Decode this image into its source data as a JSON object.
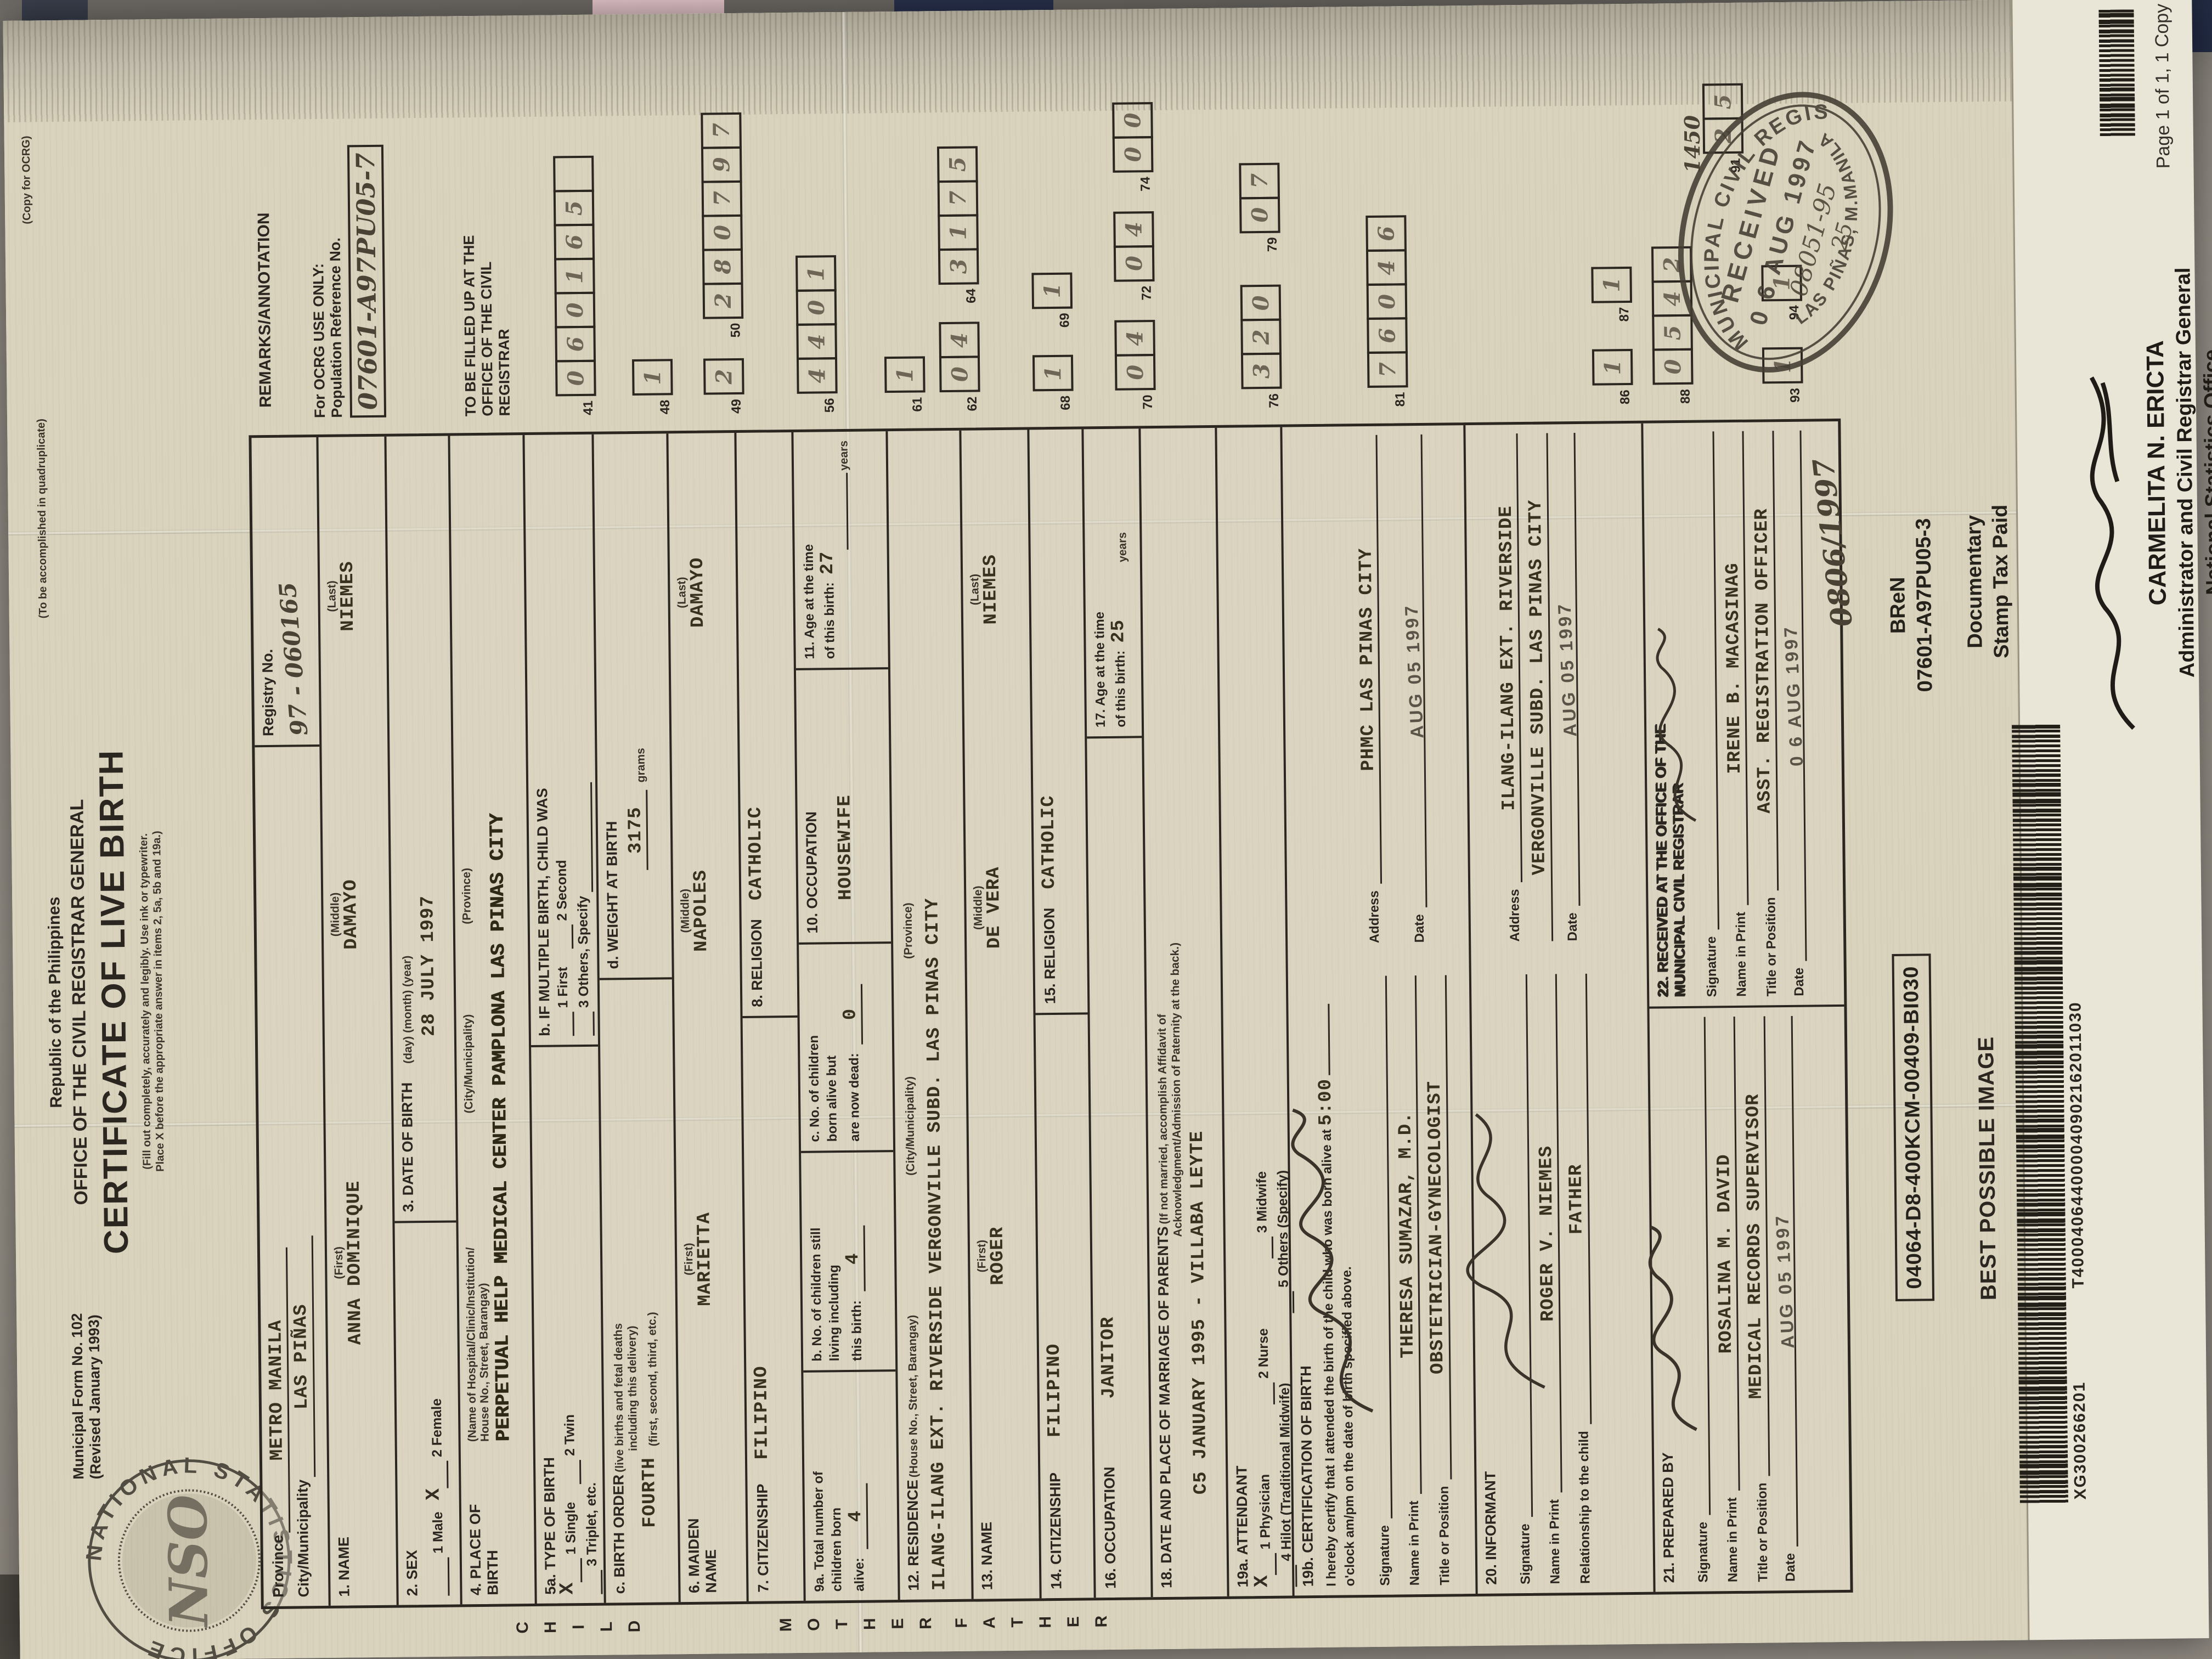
{
  "colors": {
    "paper": "#d9d3bd",
    "secpa": "#eae6d7",
    "ink": "#2b2620"
  },
  "page": {
    "copy_label": "Page 1 of 1, 1 Copy",
    "copy_for": "(Copy for OCRG)",
    "quadruplicate": "(To be accomplished in quadruplicate)"
  },
  "header": {
    "form_no": "Municipal Form No. 102",
    "revised": "(Revised January 1993)",
    "republic": "Republic of the Philippines",
    "office": "OFFICE OF THE CIVIL REGISTRAR GENERAL",
    "title": "CERTIFICATE OF LIVE BIRTH",
    "instr1": "(Fill out completely, accurately and legibly. Use ink or typewriter.",
    "instr2": "Place X before the appropriate answer in items 2, 5a, 5b and 19a.)"
  },
  "seal": {
    "ring_text": "NATIONAL STATISTICS OFFICE",
    "center": "NSO"
  },
  "registry": {
    "province_label": "Province",
    "province": "METRO MANILA",
    "city_label": "City/Municipality",
    "city": "LAS PIÑAS",
    "registry_label": "Registry No.",
    "registry_value": "97 - 060165"
  },
  "child": {
    "side": "CHILD",
    "name_label": "1. NAME",
    "first_label": "(First)",
    "middle_label": "(Middle)",
    "last_label": "(Last)",
    "first": "ANNA DOMINIQUE",
    "middle": "DAMAYO",
    "last": "NIEMES",
    "sex_label": "2. SEX",
    "male": "1 Male",
    "female": "2 Female",
    "sex_mark": "X",
    "dob_label": "3. DATE OF BIRTH",
    "dob_sub": "(day)   (month)   (year)",
    "dob": "28 JULY 1997",
    "pob_label": "4. PLACE OF",
    "pob_label2": "BIRTH",
    "pob_sub1": "(Name of Hospital/Clinic/Institution/",
    "pob_sub2": "House No., Street, Barangay)",
    "pob_sub3": "(City/Municipality)",
    "pob_sub4": "(Province)",
    "pob": "PERPETUAL HELP MEDICAL CENTER PAMPLONA LAS PINAS CITY",
    "tob_label": "5a. TYPE OF BIRTH",
    "tob_mark": "X",
    "tob1": "1 Single",
    "tob2": "2 Twin",
    "tob3": "3 Triplet, etc.",
    "mult_label": "b. IF MULTIPLE BIRTH, CHILD WAS",
    "mult1": "1 First",
    "mult2": "2 Second",
    "mult3": "3 Others, Specify",
    "order_label": "c. BIRTH ORDER",
    "order_sub1": "(live births and fetal deaths",
    "order_sub2": "including this delivery)",
    "order_sub3": "(first, second, third, etc.)",
    "order": "FOURTH",
    "weight_label": "d. WEIGHT AT BIRTH",
    "weight": "3175",
    "grams": "grams"
  },
  "mother": {
    "side": "MOTHER",
    "name_label": "6. MAIDEN",
    "name_label2": "NAME",
    "first": "MARIETTA",
    "middle": "NAPOLES",
    "last": "DAMAYO",
    "cit_label": "7. CITIZENSHIP",
    "cit": "FILIPINO",
    "rel_label": "8. RELIGION",
    "rel": "CATHOLIC",
    "a1": "9a. Total number of",
    "a2": "children born",
    "a3": "alive:",
    "a": "4",
    "b1": "b. No. of children still",
    "b2": "living including",
    "b3": "this birth:",
    "b": "4",
    "c1": "c. No. of children",
    "c2": "born alive but",
    "c3": "are now dead:",
    "c": "0",
    "occ_label": "10. OCCUPATION",
    "occ": "HOUSEWIFE",
    "age1": "11. Age at the time",
    "age2": "of this birth:",
    "age": "27",
    "years": "years",
    "res_label": "12. RESIDENCE",
    "res_sub1": "(House No., Street, Barangay)",
    "res_sub2": "(City/Municipality)",
    "res_sub3": "(Province)",
    "res": "ILANG-ILANG EXT. RIVERSIDE VERGONVILLE SUBD. LAS PINAS CITY"
  },
  "father": {
    "side": "FATHER",
    "name_label": "13. NAME",
    "first": "ROGER",
    "middle": "DE VERA",
    "last": "NIEMES",
    "cit_label": "14. CITIZENSHIP",
    "cit": "FILIPINO",
    "rel_label": "15. RELIGION",
    "rel": "CATHOLIC",
    "occ_label": "16. OCCUPATION",
    "occ": "JANITOR",
    "age1": "17. Age at the time",
    "age2": "of this birth:",
    "age": "25",
    "years": "years"
  },
  "marriage": {
    "label": "18. DATE AND PLACE OF MARRIAGE OF PARENTS",
    "note1": "(If not married, accomplish Affidavit of",
    "note2": "Acknowledgment/Admission of Paternity at the back.)",
    "value": "C5 JANUARY 1995 - VILLABA LEYTE"
  },
  "attendant": {
    "label": "19a. ATTENDANT",
    "mark": "X",
    "o1": "1 Physician",
    "o2": "2 Nurse",
    "o3": "3 Midwife",
    "o4": "4 Hilot (Traditional Midwife)",
    "o5": "5 Others (Specify)"
  },
  "certification": {
    "label": "19b. CERTIFICATION OF BIRTH",
    "text1": "I hereby certify that I attended the birth of the child who was born alive at",
    "time": "5:00",
    "text2": "o'clock",
    "text3": "am/pm on the date of birth specified above.",
    "sig_label": "Signature",
    "name_label": "Name in Print",
    "name": "THERESA SUMAZAR, M.D.",
    "title_label": "Title or Position",
    "title": "OBSTETRICIAN-GYNECOLOGIST",
    "addr_label": "Address",
    "addr": "PHMC LAS PINAS CITY",
    "date_label": "Date",
    "date": "AUG 05 1997"
  },
  "informant": {
    "label": "20. INFORMANT",
    "sig_label": "Signature",
    "name_label": "Name in Print",
    "name": "ROGER V. NIEMES",
    "rel_label": "Relationship to the child",
    "rel": "FATHER",
    "addr_label": "Address",
    "addr1": "ILANG-ILANG EXT. RIVERSIDE",
    "addr2": "VERGONVILLE SUBD. LAS PINAS CITY",
    "date_label": "Date",
    "date": "AUG 05 1997"
  },
  "prepared": {
    "label": "21. PREPARED BY",
    "sig_label": "Signature",
    "name_label": "Name in Print",
    "name": "ROSALINA M. DAVID",
    "title_label": "Title or Position",
    "title": "MEDICAL RECORDS SUPERVISOR",
    "date_label": "Date",
    "date": "AUG 05 1997"
  },
  "received": {
    "label": "22. RECEIVED AT THE OFFICE OF THE",
    "label2": "MUNICIPAL CIVIL REGISTRAR",
    "sig_label": "Signature",
    "name_label": "Name in Print",
    "name": "IRENE B. MACASINAG",
    "title_label": "Title or Position",
    "title": "ASST. REGISTRATION OFFICER",
    "date_label": "Date",
    "date": "0 6 AUG 1997"
  },
  "ocrg": {
    "remarks_title": "REMARKS/ANNOTATION",
    "ocrg_only": "For OCRG USE ONLY:",
    "pop_ref": "Population Reference No.",
    "pop_ref_value": "07601-A97PU05-7",
    "fill_up1": "TO BE FILLED UP AT THE",
    "fill_up2": "OFFICE OF THE CIVIL",
    "fill_up3": "REGISTRAR",
    "g41": {
      "label": "41",
      "digits": "060165_"
    },
    "g48": {
      "label": "48",
      "digits": "1"
    },
    "g49": {
      "label": "49",
      "digits": "2"
    },
    "g50": {
      "label": "50",
      "digits": "280797"
    },
    "g56": {
      "label": "56",
      "digits": "4401"
    },
    "g61": {
      "label": "61",
      "digits": "1"
    },
    "g62": {
      "label": "62",
      "digits": "04"
    },
    "g64": {
      "label": "64",
      "digits": "3175"
    },
    "g68": {
      "label": "68",
      "digits": "1"
    },
    "g69": {
      "label": "69",
      "digits": "1"
    },
    "g70": {
      "label": "70",
      "digits": "04"
    },
    "g72": {
      "label": "72",
      "digits": "04"
    },
    "g74": {
      "label": "74",
      "digits": "00"
    },
    "g76": {
      "label": "76",
      "digits": "320"
    },
    "g79": {
      "label": "79",
      "digits": "07"
    },
    "g81": {
      "label": "81",
      "digits": "76046"
    },
    "g86": {
      "label": "86",
      "digits": "1"
    },
    "g87": {
      "label": "87",
      "digits": "1"
    },
    "g88": {
      "label": "88",
      "digits": "0542"
    },
    "g91": {
      "label": "91",
      "digits": "25"
    },
    "g91_hand": "1450",
    "g93": {
      "label": "93",
      "digits": "1"
    },
    "g94": {
      "label": "94",
      "digits": "1"
    }
  },
  "stamp": {
    "ring_top": "MUNICIPAL CIVIL REGISTRAR",
    "received": "RECEIVED",
    "date": "0 6 AUG 1997",
    "hand1": "08051-95",
    "hand2": "25",
    "ring_bottom": "LAS PIÑAS, M.MANILA",
    "side_hand": "0806/1997"
  },
  "bottom": {
    "batch_label": "04064-D8-400KCM-00409-BI030",
    "best": "BEST POSSIBLE IMAGE",
    "barcode_num": "T400040644000040902162011030",
    "xg": "XG300266201",
    "bren": "BReN",
    "bren_no": "07601-A97PU05-3",
    "doc1": "Documentary",
    "doc2": "Stamp Tax Paid"
  },
  "secpa": {
    "name": "CARMELITA N. ERICTA",
    "title1": "Administrator and Civil Registrar General",
    "title2": "National Statistics Office"
  }
}
